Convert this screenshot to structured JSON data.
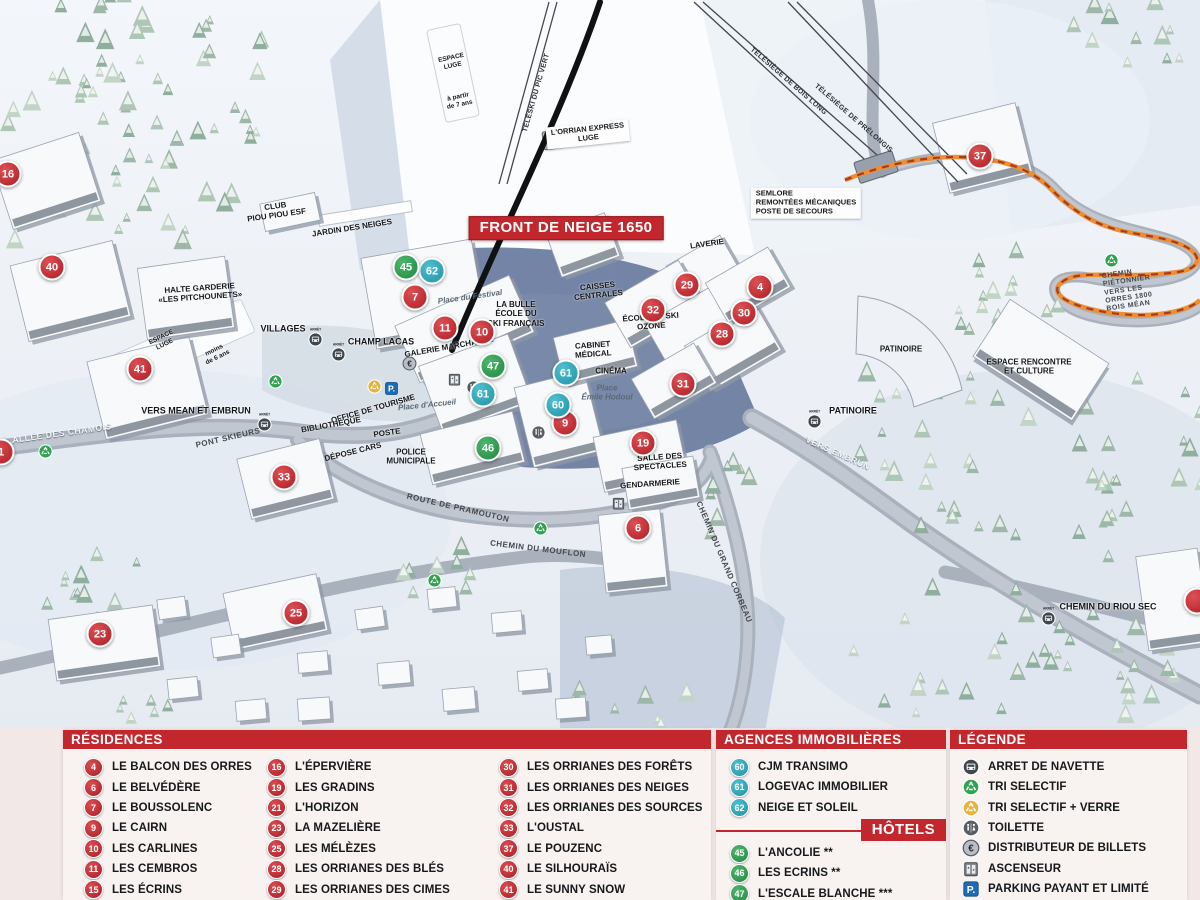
{
  "map": {
    "banner": {
      "text": "FRONT DE NEIGE 1650",
      "x": 566,
      "y": 228
    },
    "arret_caption": "ARRÊT",
    "markers": [
      {
        "n": "16",
        "t": "r",
        "x": 8,
        "y": 174
      },
      {
        "n": "40",
        "t": "r",
        "x": 52,
        "y": 267
      },
      {
        "n": "41",
        "t": "r",
        "x": 140,
        "y": 369
      },
      {
        "n": "1",
        "t": "r",
        "x": 1,
        "y": 452
      },
      {
        "n": "33",
        "t": "r",
        "x": 284,
        "y": 477
      },
      {
        "n": "23",
        "t": "r",
        "x": 100,
        "y": 634
      },
      {
        "n": "25",
        "t": "r",
        "x": 296,
        "y": 613
      },
      {
        "n": "7",
        "t": "r",
        "x": 415,
        "y": 297
      },
      {
        "n": "11",
        "t": "r",
        "x": 445,
        "y": 328
      },
      {
        "n": "10",
        "t": "r",
        "x": 482,
        "y": 332
      },
      {
        "n": "29",
        "t": "r",
        "x": 687,
        "y": 285
      },
      {
        "n": "32",
        "t": "r",
        "x": 653,
        "y": 310
      },
      {
        "n": "4",
        "t": "r",
        "x": 760,
        "y": 287
      },
      {
        "n": "30",
        "t": "r",
        "x": 744,
        "y": 313
      },
      {
        "n": "28",
        "t": "r",
        "x": 722,
        "y": 334
      },
      {
        "n": "31",
        "t": "r",
        "x": 683,
        "y": 384
      },
      {
        "n": "9",
        "t": "r",
        "x": 565,
        "y": 423
      },
      {
        "n": "19",
        "t": "r",
        "x": 643,
        "y": 443
      },
      {
        "n": "6",
        "t": "r",
        "x": 638,
        "y": 528
      },
      {
        "n": "37",
        "t": "r",
        "x": 980,
        "y": 156
      },
      {
        "n": "",
        "t": "r",
        "x": 1197,
        "y": 601
      },
      {
        "n": "62",
        "t": "a",
        "x": 432,
        "y": 271
      },
      {
        "n": "61",
        "t": "a",
        "x": 483,
        "y": 394
      },
      {
        "n": "61",
        "t": "a",
        "x": 566,
        "y": 373
      },
      {
        "n": "60",
        "t": "a",
        "x": 558,
        "y": 405
      },
      {
        "n": "45",
        "t": "h",
        "x": 406,
        "y": 267
      },
      {
        "n": "47",
        "t": "h",
        "x": 493,
        "y": 366
      },
      {
        "n": "46",
        "t": "h",
        "x": 488,
        "y": 448
      }
    ],
    "labels": [
      {
        "t": "CLUB\nPIOU PIOU ESF",
        "x": 276,
        "y": 211,
        "k": "fac",
        "r": -8
      },
      {
        "t": "JARDIN DES NEIGES",
        "x": 352,
        "y": 228,
        "k": "fac",
        "r": -9
      },
      {
        "t": "HALTE GARDERIE\n«LES PITCHOUNETS»",
        "x": 200,
        "y": 293,
        "k": "fac",
        "r": -4
      },
      {
        "t": "ESPACE\nLUGE",
        "x": 163,
        "y": 341,
        "k": "fac",
        "r": -26,
        "fs": 6.5
      },
      {
        "t": "moins\nde 6 ans",
        "x": 216,
        "y": 354,
        "k": "fac",
        "r": -26,
        "fs": 6.5
      },
      {
        "t": "ESPACE\nLUGE",
        "x": 452,
        "y": 62,
        "k": "fac",
        "r": -12,
        "fs": 6.5
      },
      {
        "t": "à partir\nde 7 ans",
        "x": 459,
        "y": 101,
        "k": "fac",
        "r": -12,
        "fs": 6.5
      },
      {
        "t": "VILLAGES",
        "x": 283,
        "y": 329,
        "k": "stop"
      },
      {
        "t": "CHAMP LACAS",
        "x": 381,
        "y": 342,
        "k": "stop"
      },
      {
        "t": "VERS MEAN ET EMBRUN",
        "x": 196,
        "y": 411,
        "k": "stop"
      },
      {
        "t": "PATINOIRE",
        "x": 853,
        "y": 411,
        "k": "stop"
      },
      {
        "t": "CHEMIN DU RIOU SEC",
        "x": 1108,
        "y": 607,
        "k": "stop"
      },
      {
        "t": "PONT SKIEURS",
        "x": 228,
        "y": 438,
        "k": "road",
        "r": -13
      },
      {
        "t": "ALLÉE DES CHAMOIS",
        "x": 62,
        "y": 433,
        "k": "roadw",
        "r": -8
      },
      {
        "t": "OFFICE DE TOURISME",
        "x": 373,
        "y": 409,
        "k": "fac",
        "r": -16
      },
      {
        "t": "BIBLIOTHÈQUE",
        "x": 331,
        "y": 425,
        "k": "fac",
        "r": -10
      },
      {
        "t": "POSTE",
        "x": 387,
        "y": 433,
        "k": "fac",
        "r": -8
      },
      {
        "t": "DÉPOSE CARS",
        "x": 353,
        "y": 452,
        "k": "fac",
        "r": -14
      },
      {
        "t": "POLICE\nMUNICIPALE",
        "x": 411,
        "y": 457,
        "k": "fac"
      },
      {
        "t": "Place d'Accueil",
        "x": 427,
        "y": 405,
        "k": "place",
        "r": -6
      },
      {
        "t": "Place du Festival",
        "x": 470,
        "y": 297,
        "k": "place",
        "r": -8
      },
      {
        "t": "LA BULLE\nÉCOLE DU\nSKI FRANÇAIS",
        "x": 516,
        "y": 314,
        "k": "fac"
      },
      {
        "t": "CAISSES\nCENTRALES",
        "x": 598,
        "y": 291,
        "k": "fac",
        "r": -6
      },
      {
        "t": "CABINET\nMÉDICAL",
        "x": 593,
        "y": 350,
        "k": "fac",
        "r": -4
      },
      {
        "t": "CINÉMA",
        "x": 611,
        "y": 371,
        "k": "fac"
      },
      {
        "t": "Place\nÉmile Hodoul",
        "x": 607,
        "y": 393,
        "k": "place"
      },
      {
        "t": "GALERIE MARCHANDE",
        "x": 449,
        "y": 347,
        "k": "fac",
        "r": -10
      },
      {
        "t": "ÉCOLE DE SKI\nOZONE",
        "x": 651,
        "y": 322,
        "k": "fac",
        "r": -4
      },
      {
        "t": "LAVERIE",
        "x": 707,
        "y": 244,
        "k": "fac",
        "r": -8
      },
      {
        "t": "SALLE DES\nSPECTACLES",
        "x": 660,
        "y": 462,
        "k": "fac",
        "r": -4
      },
      {
        "t": "GENDARMERIE",
        "x": 650,
        "y": 484,
        "k": "fac",
        "r": -4
      },
      {
        "t": "PATINOIRE",
        "x": 901,
        "y": 349,
        "k": "fac"
      },
      {
        "t": "ESPACE RENCONTRE\nET CULTURE",
        "x": 1029,
        "y": 367,
        "k": "fac"
      },
      {
        "t": "SEMLORE\nREMONTÉES MÉCANIQUES\nPOSTE DE SECOURS",
        "x": 806,
        "y": 203,
        "k": "facbox",
        "al": "left"
      },
      {
        "t": "VERS EMBRUN",
        "x": 838,
        "y": 453,
        "k": "roadw",
        "r": 24
      },
      {
        "t": "ROUTE DE PRAMOUTON",
        "x": 458,
        "y": 508,
        "k": "road",
        "r": 13
      },
      {
        "t": "CHEMIN DU MOUFLON",
        "x": 538,
        "y": 549,
        "k": "road",
        "r": 7
      },
      {
        "t": "CHEMIN DU GRAND CORBEAU",
        "x": 724,
        "y": 562,
        "k": "road",
        "r": 67
      },
      {
        "t": "CHEMIN PIÉTONNIER\nVERS LES ORRES 1800\nBOIS MÉAN",
        "x": 1136,
        "y": 289,
        "k": "road",
        "r": -8,
        "al": "left",
        "fs": 7
      },
      {
        "t": "TÉLÉSKI DU PIC VERT",
        "x": 537,
        "y": 93,
        "k": "lift",
        "r": -74
      },
      {
        "t": "L'ORRIAN EXPRESS\nLUGE",
        "x": 588,
        "y": 134,
        "k": "facbox",
        "r": -6
      },
      {
        "t": "TÉLÉSIÈGE DE BOIS LONG",
        "x": 788,
        "y": 82,
        "k": "lift",
        "r": 41
      },
      {
        "t": "TÉLÉSIÈGE DE PRÉLONGIS",
        "x": 853,
        "y": 119,
        "k": "lift",
        "r": 41
      }
    ],
    "icons": [
      {
        "t": "bus",
        "x": 308,
        "y": 327,
        "cap": true
      },
      {
        "t": "bus",
        "x": 331,
        "y": 342,
        "cap": true
      },
      {
        "t": "bus",
        "x": 257,
        "y": 412,
        "cap": true
      },
      {
        "t": "bus",
        "x": 807,
        "y": 409,
        "cap": true
      },
      {
        "t": "bus",
        "x": 1041,
        "y": 606,
        "cap": true
      },
      {
        "t": "recycle-green",
        "x": 38,
        "y": 444
      },
      {
        "t": "recycle-green",
        "x": 268,
        "y": 374
      },
      {
        "t": "recycle-green",
        "x": 427,
        "y": 573
      },
      {
        "t": "recycle-green",
        "x": 533,
        "y": 521
      },
      {
        "t": "recycle-green",
        "x": 1104,
        "y": 253
      },
      {
        "t": "recycle-yellow",
        "x": 367,
        "y": 379
      },
      {
        "t": "parking",
        "x": 384,
        "y": 381
      },
      {
        "t": "atm",
        "x": 402,
        "y": 356
      },
      {
        "t": "elevator",
        "x": 447,
        "y": 372
      },
      {
        "t": "toilet",
        "x": 466,
        "y": 380
      },
      {
        "t": "toilet",
        "x": 531,
        "y": 425
      },
      {
        "t": "elevator",
        "x": 611,
        "y": 496
      }
    ]
  },
  "panel": {
    "residences": {
      "title": "RÉSIDENCES",
      "columns": [
        [
          {
            "n": "4",
            "name": "LE BALCON DES ORRES"
          },
          {
            "n": "6",
            "name": "LE BELVÉDÈRE"
          },
          {
            "n": "7",
            "name": "LE BOUSSOLENC"
          },
          {
            "n": "9",
            "name": "LE CAIRN"
          },
          {
            "n": "10",
            "name": "LES CARLINES"
          },
          {
            "n": "11",
            "name": "LES CEMBROS"
          },
          {
            "n": "15",
            "name": "LES ÉCRINS"
          }
        ],
        [
          {
            "n": "16",
            "name": "L'ÉPERVIÈRE"
          },
          {
            "n": "19",
            "name": "LES GRADINS"
          },
          {
            "n": "21",
            "name": "L'HORIZON"
          },
          {
            "n": "23",
            "name": "LA MAZELIÈRE"
          },
          {
            "n": "25",
            "name": "LES MÉLÈZES"
          },
          {
            "n": "28",
            "name": "LES ORRIANES DES BLÉS"
          },
          {
            "n": "29",
            "name": "LES ORRIANES DES CIMES"
          }
        ],
        [
          {
            "n": "30",
            "name": "LES ORRIANES DES FORÊTS"
          },
          {
            "n": "31",
            "name": "LES ORRIANES DES NEIGES"
          },
          {
            "n": "32",
            "name": "LES ORRIANES DES SOURCES"
          },
          {
            "n": "33",
            "name": "L'OUSTAL"
          },
          {
            "n": "37",
            "name": "LE POUZENC"
          },
          {
            "n": "40",
            "name": "LE SILHOURAÏS"
          },
          {
            "n": "41",
            "name": "LE SUNNY SNOW"
          }
        ]
      ]
    },
    "agences": {
      "title": "AGENCES IMMOBILIÈRES",
      "items": [
        {
          "n": "60",
          "name": "CJM TRANSIMO"
        },
        {
          "n": "61",
          "name": "LOGEVAC IMMOBILIER"
        },
        {
          "n": "62",
          "name": "NEIGE ET SOLEIL"
        }
      ]
    },
    "hotels": {
      "title": "HÔTELS",
      "items": [
        {
          "n": "45",
          "name": "L'ANCOLIE **"
        },
        {
          "n": "46",
          "name": "LES ECRINS **"
        },
        {
          "n": "47",
          "name": "L'ESCALE BLANCHE ***"
        },
        {
          "n": "49",
          "name": "LES TRAPPEURS **"
        }
      ]
    },
    "legende": {
      "title": "LÉGENDE",
      "items": [
        {
          "icon": "bus",
          "label": "ARRET DE NAVETTE"
        },
        {
          "icon": "recycle-green",
          "label": "TRI SELECTIF"
        },
        {
          "icon": "recycle-yellow",
          "label": "TRI SELECTIF + VERRE"
        },
        {
          "icon": "toilet",
          "label": "TOILETTE"
        },
        {
          "icon": "atm",
          "label": "DISTRIBUTEUR DE BILLETS"
        },
        {
          "icon": "elevator",
          "label": "ASCENSEUR"
        },
        {
          "icon": "parking",
          "label": "PARKING PAYANT ET LIMITÉ"
        }
      ]
    }
  },
  "colors": {
    "residence": "#c1272d",
    "agence": "#2aa5b8",
    "hotel": "#2f9e4e",
    "header": "#c1272d",
    "path": "#ee8e33"
  }
}
